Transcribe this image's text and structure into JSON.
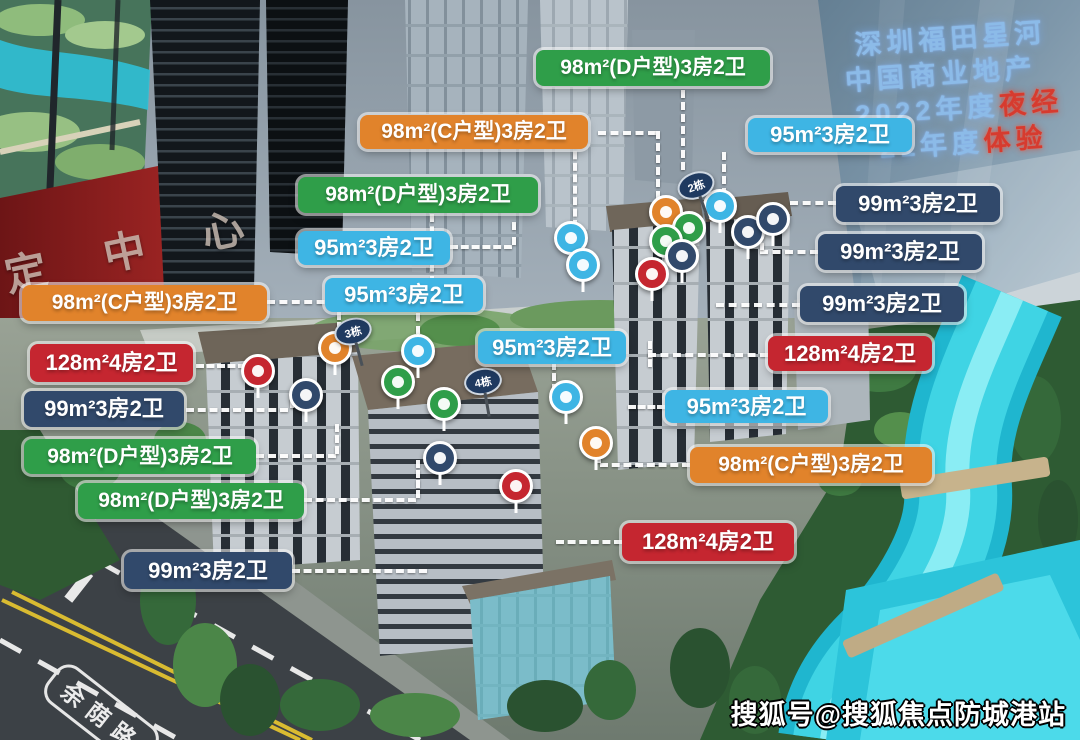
{
  "palette": {
    "green": "#2f9e49",
    "orange": "#e1832b",
    "cyan": "#3eb5e4",
    "navy": "#31496b",
    "red": "#c52630"
  },
  "screen": {
    "line1": "深圳福田星河",
    "line2": "中国商业地产",
    "line3_prefix": "2022年度",
    "line3_highlight": "夜经",
    "line4_prefix": "21年度",
    "line4_highlight": "体验"
  },
  "banner": {
    "text": "定 中 心"
  },
  "road": {
    "name": "余荫路"
  },
  "watermark": {
    "text": "搜狐号@搜狐焦点防城港站"
  },
  "building_signs": [
    {
      "text": "2栋",
      "x": 696,
      "y": 186,
      "rot": -20
    },
    {
      "text": "3栋",
      "x": 353,
      "y": 332,
      "rot": -15
    },
    {
      "text": "4栋",
      "x": 483,
      "y": 382,
      "rot": -10
    }
  ],
  "unit_labels": [
    {
      "text": "98m²(D户型)3房2卫",
      "color": "green",
      "x": 536,
      "y": 50,
      "w": 234,
      "h": 36
    },
    {
      "text": "98m²(C户型)3房2卫",
      "color": "orange",
      "x": 360,
      "y": 115,
      "w": 228,
      "h": 34
    },
    {
      "text": "95m²3房2卫",
      "color": "cyan",
      "x": 748,
      "y": 118,
      "w": 164,
      "h": 34
    },
    {
      "text": "98m²(D户型)3房2卫",
      "color": "green",
      "x": 298,
      "y": 177,
      "w": 240,
      "h": 36
    },
    {
      "text": "99m²3房2卫",
      "color": "navy",
      "x": 836,
      "y": 186,
      "w": 164,
      "h": 36
    },
    {
      "text": "95m²3房2卫",
      "color": "cyan",
      "x": 298,
      "y": 231,
      "w": 152,
      "h": 34
    },
    {
      "text": "99m²3房2卫",
      "color": "navy",
      "x": 818,
      "y": 234,
      "w": 164,
      "h": 36
    },
    {
      "text": "95m²3房2卫",
      "color": "cyan",
      "x": 325,
      "y": 278,
      "w": 158,
      "h": 34
    },
    {
      "text": "99m²3房2卫",
      "color": "navy",
      "x": 800,
      "y": 286,
      "w": 164,
      "h": 36
    },
    {
      "text": "98m²(C户型)3房2卫",
      "color": "orange",
      "x": 22,
      "y": 285,
      "w": 245,
      "h": 36
    },
    {
      "text": "128m²4房2卫",
      "color": "red",
      "x": 768,
      "y": 336,
      "w": 164,
      "h": 35
    },
    {
      "text": "95m²3房2卫",
      "color": "cyan",
      "x": 478,
      "y": 331,
      "w": 148,
      "h": 33
    },
    {
      "text": "128m²4房2卫",
      "color": "red",
      "x": 30,
      "y": 344,
      "w": 163,
      "h": 38
    },
    {
      "text": "99m²3房2卫",
      "color": "navy",
      "x": 24,
      "y": 391,
      "w": 160,
      "h": 36
    },
    {
      "text": "95m²3房2卫",
      "color": "cyan",
      "x": 665,
      "y": 390,
      "w": 163,
      "h": 33
    },
    {
      "text": "98m²(D户型)3房2卫",
      "color": "green",
      "x": 24,
      "y": 439,
      "w": 232,
      "h": 35
    },
    {
      "text": "98m²(C户型)3房2卫",
      "color": "orange",
      "x": 690,
      "y": 447,
      "w": 242,
      "h": 36
    },
    {
      "text": "98m²(D户型)3房2卫",
      "color": "green",
      "x": 78,
      "y": 483,
      "w": 226,
      "h": 36
    },
    {
      "text": "128m²4房2卫",
      "color": "red",
      "x": 622,
      "y": 523,
      "w": 172,
      "h": 38
    },
    {
      "text": "99m²3房2卫",
      "color": "navy",
      "x": 124,
      "y": 552,
      "w": 168,
      "h": 37
    }
  ],
  "markers": [
    {
      "color": "orange",
      "x": 666,
      "y": 212
    },
    {
      "color": "cyan",
      "x": 720,
      "y": 206
    },
    {
      "color": "green",
      "x": 689,
      "y": 228
    },
    {
      "color": "green",
      "x": 666,
      "y": 241
    },
    {
      "color": "navy",
      "x": 682,
      "y": 256
    },
    {
      "color": "red",
      "x": 652,
      "y": 274
    },
    {
      "color": "navy",
      "x": 748,
      "y": 232
    },
    {
      "color": "navy",
      "x": 773,
      "y": 219
    },
    {
      "color": "cyan",
      "x": 571,
      "y": 238
    },
    {
      "color": "cyan",
      "x": 583,
      "y": 265
    },
    {
      "color": "orange",
      "x": 335,
      "y": 348
    },
    {
      "color": "cyan",
      "x": 418,
      "y": 351
    },
    {
      "color": "green",
      "x": 398,
      "y": 382
    },
    {
      "color": "navy",
      "x": 306,
      "y": 395
    },
    {
      "color": "green",
      "x": 444,
      "y": 404
    },
    {
      "color": "cyan",
      "x": 566,
      "y": 397
    },
    {
      "color": "navy",
      "x": 440,
      "y": 458
    },
    {
      "color": "red",
      "x": 516,
      "y": 486
    },
    {
      "color": "orange",
      "x": 596,
      "y": 443
    },
    {
      "color": "red",
      "x": 258,
      "y": 371
    }
  ],
  "connectors": [
    {
      "dir": "v",
      "x": 681,
      "y": 90,
      "len": 80
    },
    {
      "dir": "h",
      "x": 598,
      "y": 131,
      "len": 58
    },
    {
      "dir": "v",
      "x": 656,
      "y": 131,
      "len": 68
    },
    {
      "dir": "v",
      "x": 573,
      "y": 140,
      "len": 88
    },
    {
      "dir": "v",
      "x": 722,
      "y": 152,
      "len": 44
    },
    {
      "dir": "h",
      "x": 790,
      "y": 201,
      "len": 46
    },
    {
      "dir": "h",
      "x": 760,
      "y": 250,
      "len": 58
    },
    {
      "dir": "v",
      "x": 760,
      "y": 232,
      "len": 18
    },
    {
      "dir": "h",
      "x": 716,
      "y": 303,
      "len": 84
    },
    {
      "dir": "v",
      "x": 648,
      "y": 341,
      "len": 26
    },
    {
      "dir": "h",
      "x": 648,
      "y": 353,
      "len": 120
    },
    {
      "dir": "h",
      "x": 628,
      "y": 405,
      "len": 37
    },
    {
      "dir": "h",
      "x": 600,
      "y": 463,
      "len": 90
    },
    {
      "dir": "v",
      "x": 597,
      "y": 447,
      "len": 16
    },
    {
      "dir": "h",
      "x": 556,
      "y": 540,
      "len": 66
    },
    {
      "dir": "v",
      "x": 552,
      "y": 362,
      "len": 30
    },
    {
      "dir": "h",
      "x": 267,
      "y": 300,
      "len": 70
    },
    {
      "dir": "v",
      "x": 337,
      "y": 302,
      "len": 28
    },
    {
      "dir": "h",
      "x": 196,
      "y": 364,
      "len": 50
    },
    {
      "dir": "h",
      "x": 186,
      "y": 408,
      "len": 102
    },
    {
      "dir": "v",
      "x": 290,
      "y": 393,
      "len": 15
    },
    {
      "dir": "h",
      "x": 256,
      "y": 454,
      "len": 80
    },
    {
      "dir": "v",
      "x": 335,
      "y": 424,
      "len": 30
    },
    {
      "dir": "h",
      "x": 304,
      "y": 498,
      "len": 112
    },
    {
      "dir": "v",
      "x": 416,
      "y": 460,
      "len": 38
    },
    {
      "dir": "h",
      "x": 292,
      "y": 569,
      "len": 135
    },
    {
      "dir": "h",
      "x": 450,
      "y": 245,
      "len": 62
    },
    {
      "dir": "v",
      "x": 512,
      "y": 222,
      "len": 23
    },
    {
      "dir": "v",
      "x": 416,
      "y": 313,
      "len": 34
    },
    {
      "dir": "v",
      "x": 430,
      "y": 214,
      "len": 70
    }
  ]
}
